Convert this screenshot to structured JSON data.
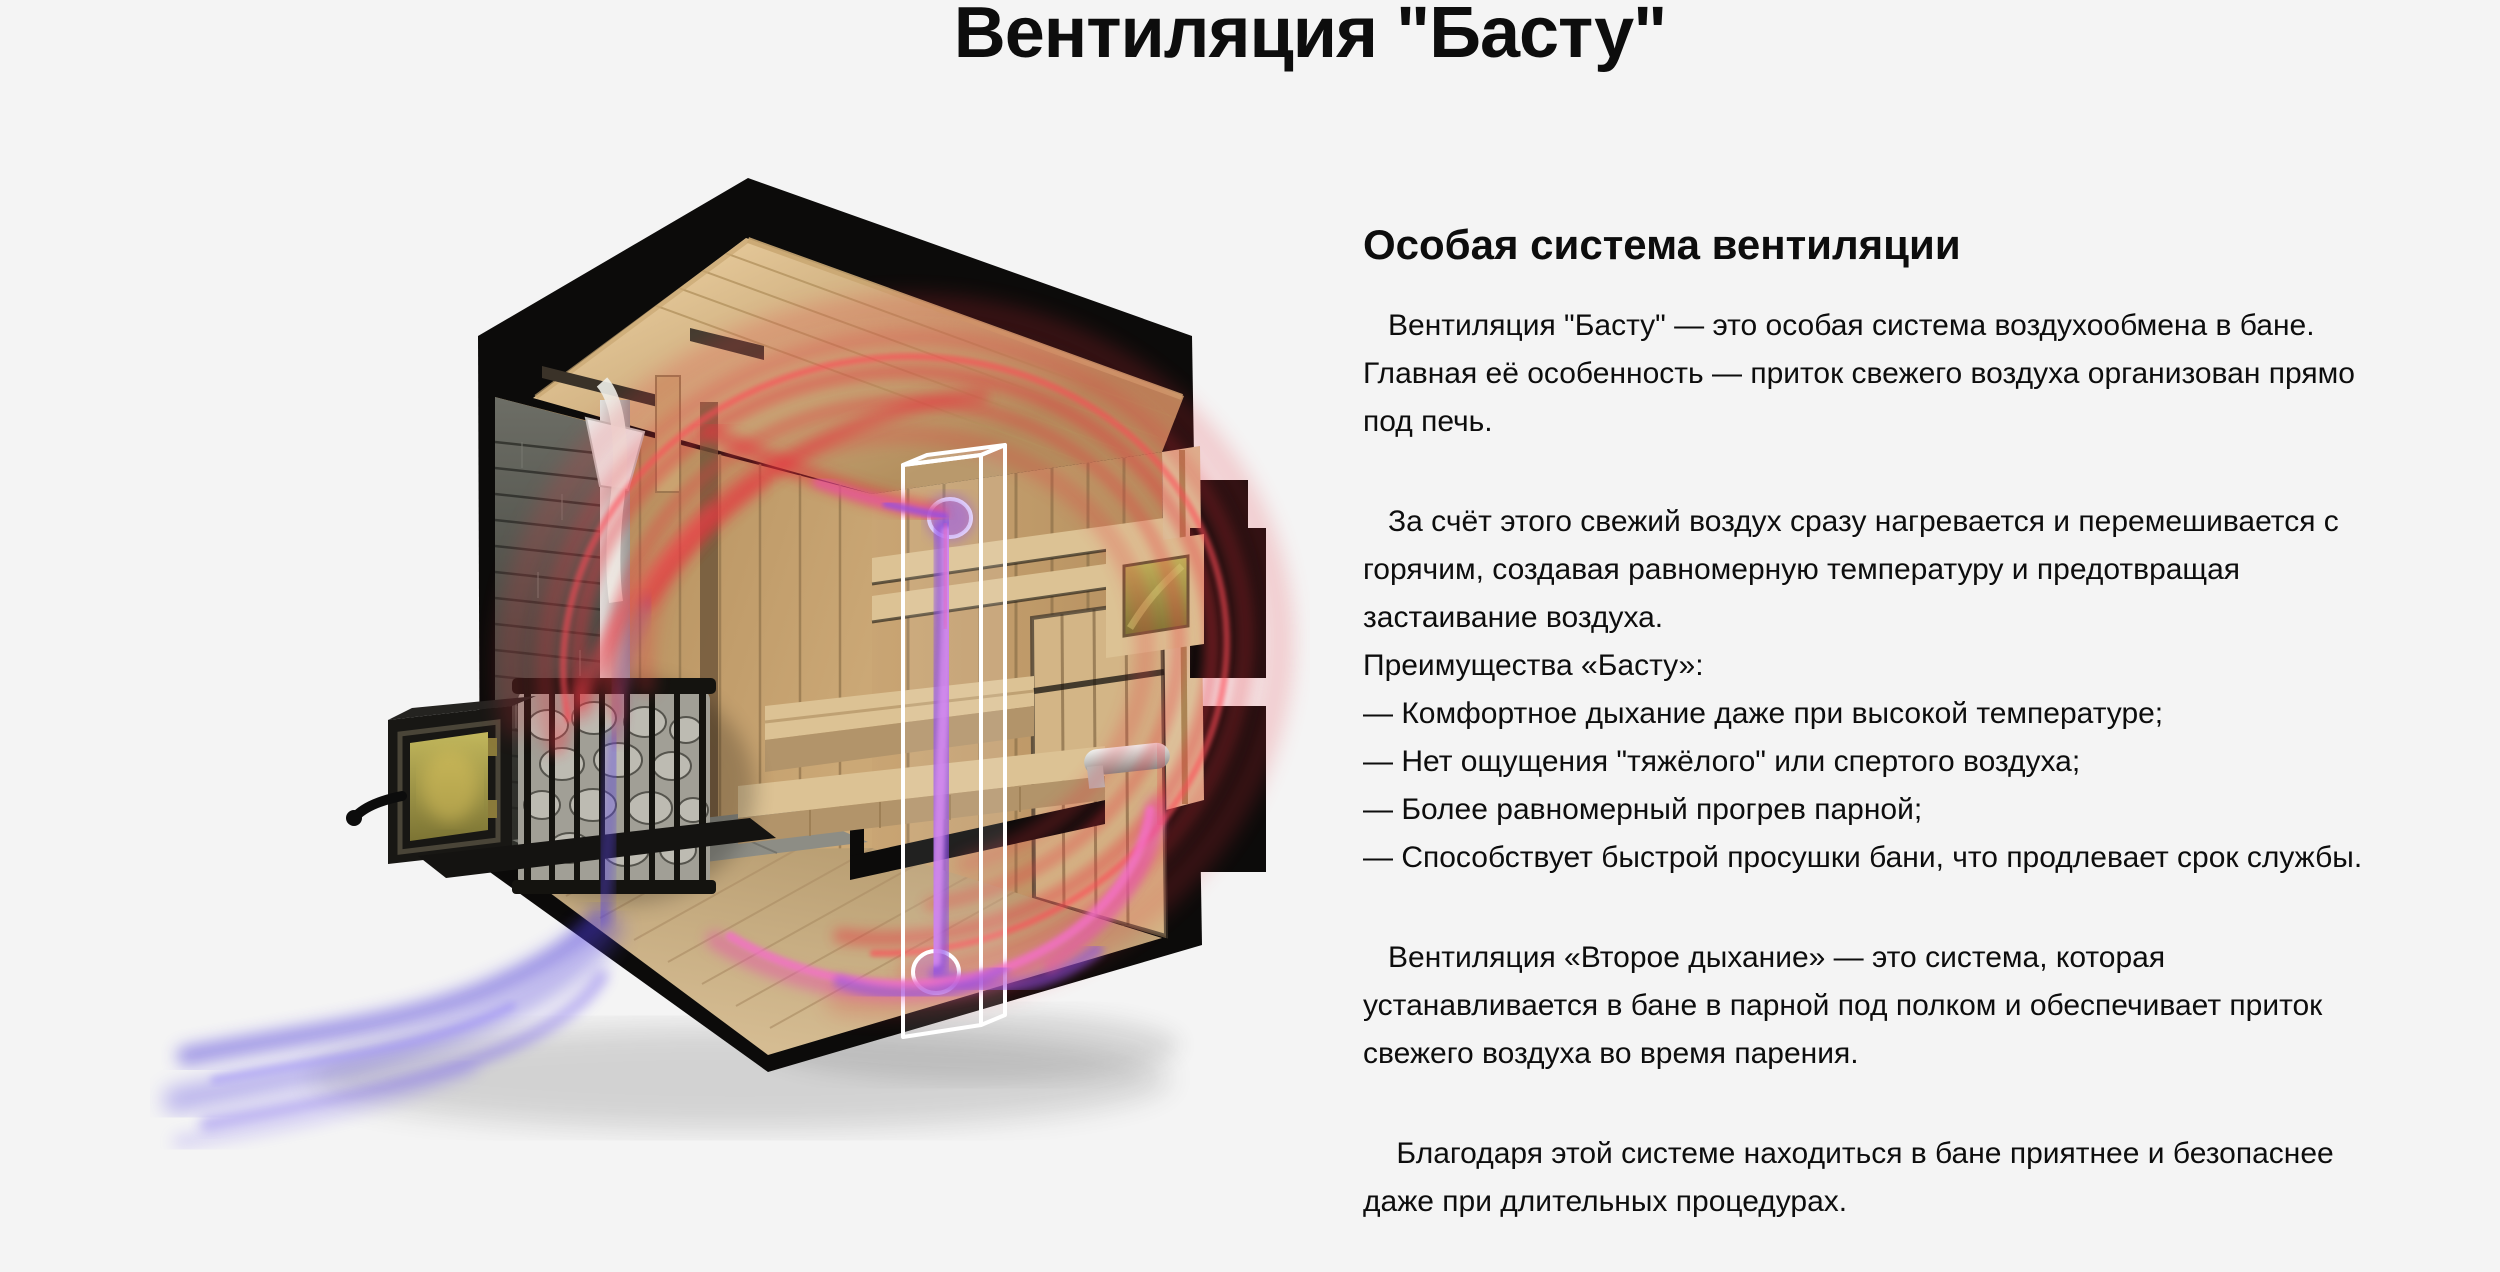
{
  "page": {
    "title": "Вентиляция \"Басту\""
  },
  "article": {
    "heading": "Особая система вентиляции",
    "paragraphs": [
      {
        "text": "   Вентиляция \"Басту\" — это особая система воздухообмена в бане.\nГлавная её особенность — приток свежего воздуха организован прямо\nпод печь."
      },
      {
        "text": "   За счёт этого свежий воздух сразу нагревается и перемешивается с\nгорячим, создавая равномерную температуру и предотвращая\nзастаивание воздуха.\nПреимущества «Басту»:\n— Комфортное дыхание даже при высокой температуре;\n— Нет ощущения \"тяжёлого\" или спертого воздуха;\n— Более равномерный прогрев парной;\n— Способствует быстрой просушки бани, что продлевает срок службы."
      },
      {
        "text": "   Вентиляция «Второе дыхание» — это система, которая\nустанавливается в бане в парной под полком и обеспечивает приток\nсвежего воздуха во время парения."
      },
      {
        "text": "    Благодаря этой системе находиться в бане приятнее и безопаснее\nдаже при длительных процедурах."
      }
    ]
  },
  "illustration": {
    "alt": "3D-разрез бани: схема вентиляции Басту — синий приток свежего воздуха под печь, красный поток горячего воздуха по кругу парной и фиолетовый вытяжной канал"
  },
  "colors": {
    "bg": "#f4f4f4",
    "ink": "#0d0d0d",
    "shell": "#0c0b0a",
    "wood-ceiling": "#cfae7d",
    "wood-wall": "#c6a271",
    "wood-wall-right": "#c09a6a",
    "wood-floor": "#c7ab80",
    "wood-bench": "#dcc294",
    "stone": "#5b5c55",
    "glass": "#b3a84e",
    "metal": "#d9dbd9",
    "flow-red": "#e8303e",
    "flow-red-bright": "#ff4854",
    "flow-pink": "#e855aa",
    "flow-purple": "#8d4fe8",
    "flow-blue": "#4838d8"
  }
}
